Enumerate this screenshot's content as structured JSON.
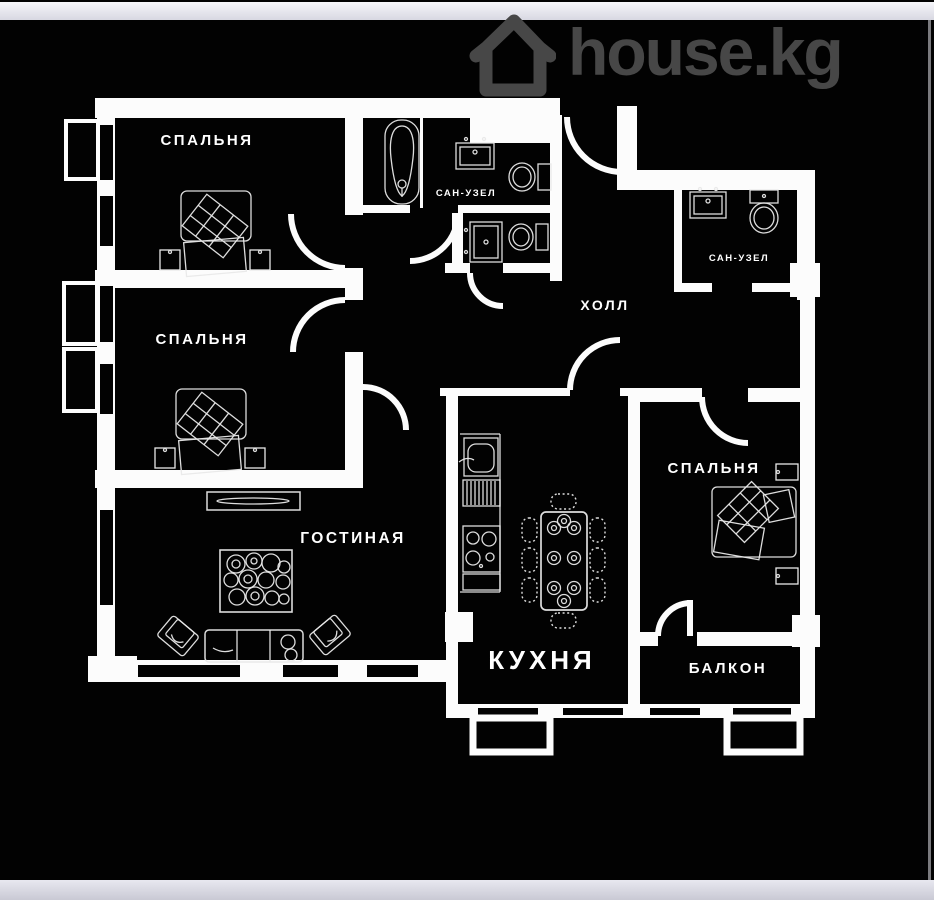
{
  "watermark": {
    "text": "house.kg",
    "color": "#474747"
  },
  "colors": {
    "background": "#020202",
    "walls": "#fcfcfc",
    "frame_bar": "#e3e3ec",
    "watermark_gray": "#474747"
  },
  "labels": {
    "bedroom1": "СПАЛЬНЯ",
    "bedroom2": "СПАЛЬНЯ",
    "bedroom3": "СПАЛЬНЯ",
    "bathroom1": "САН-УЗЕЛ",
    "bathroom2": "САН-УЗЕЛ",
    "hall": "ХОЛЛ",
    "living_room": "ГОСТИНАЯ",
    "kitchen": "КУХНЯ",
    "balcony": "БАЛКОН"
  }
}
